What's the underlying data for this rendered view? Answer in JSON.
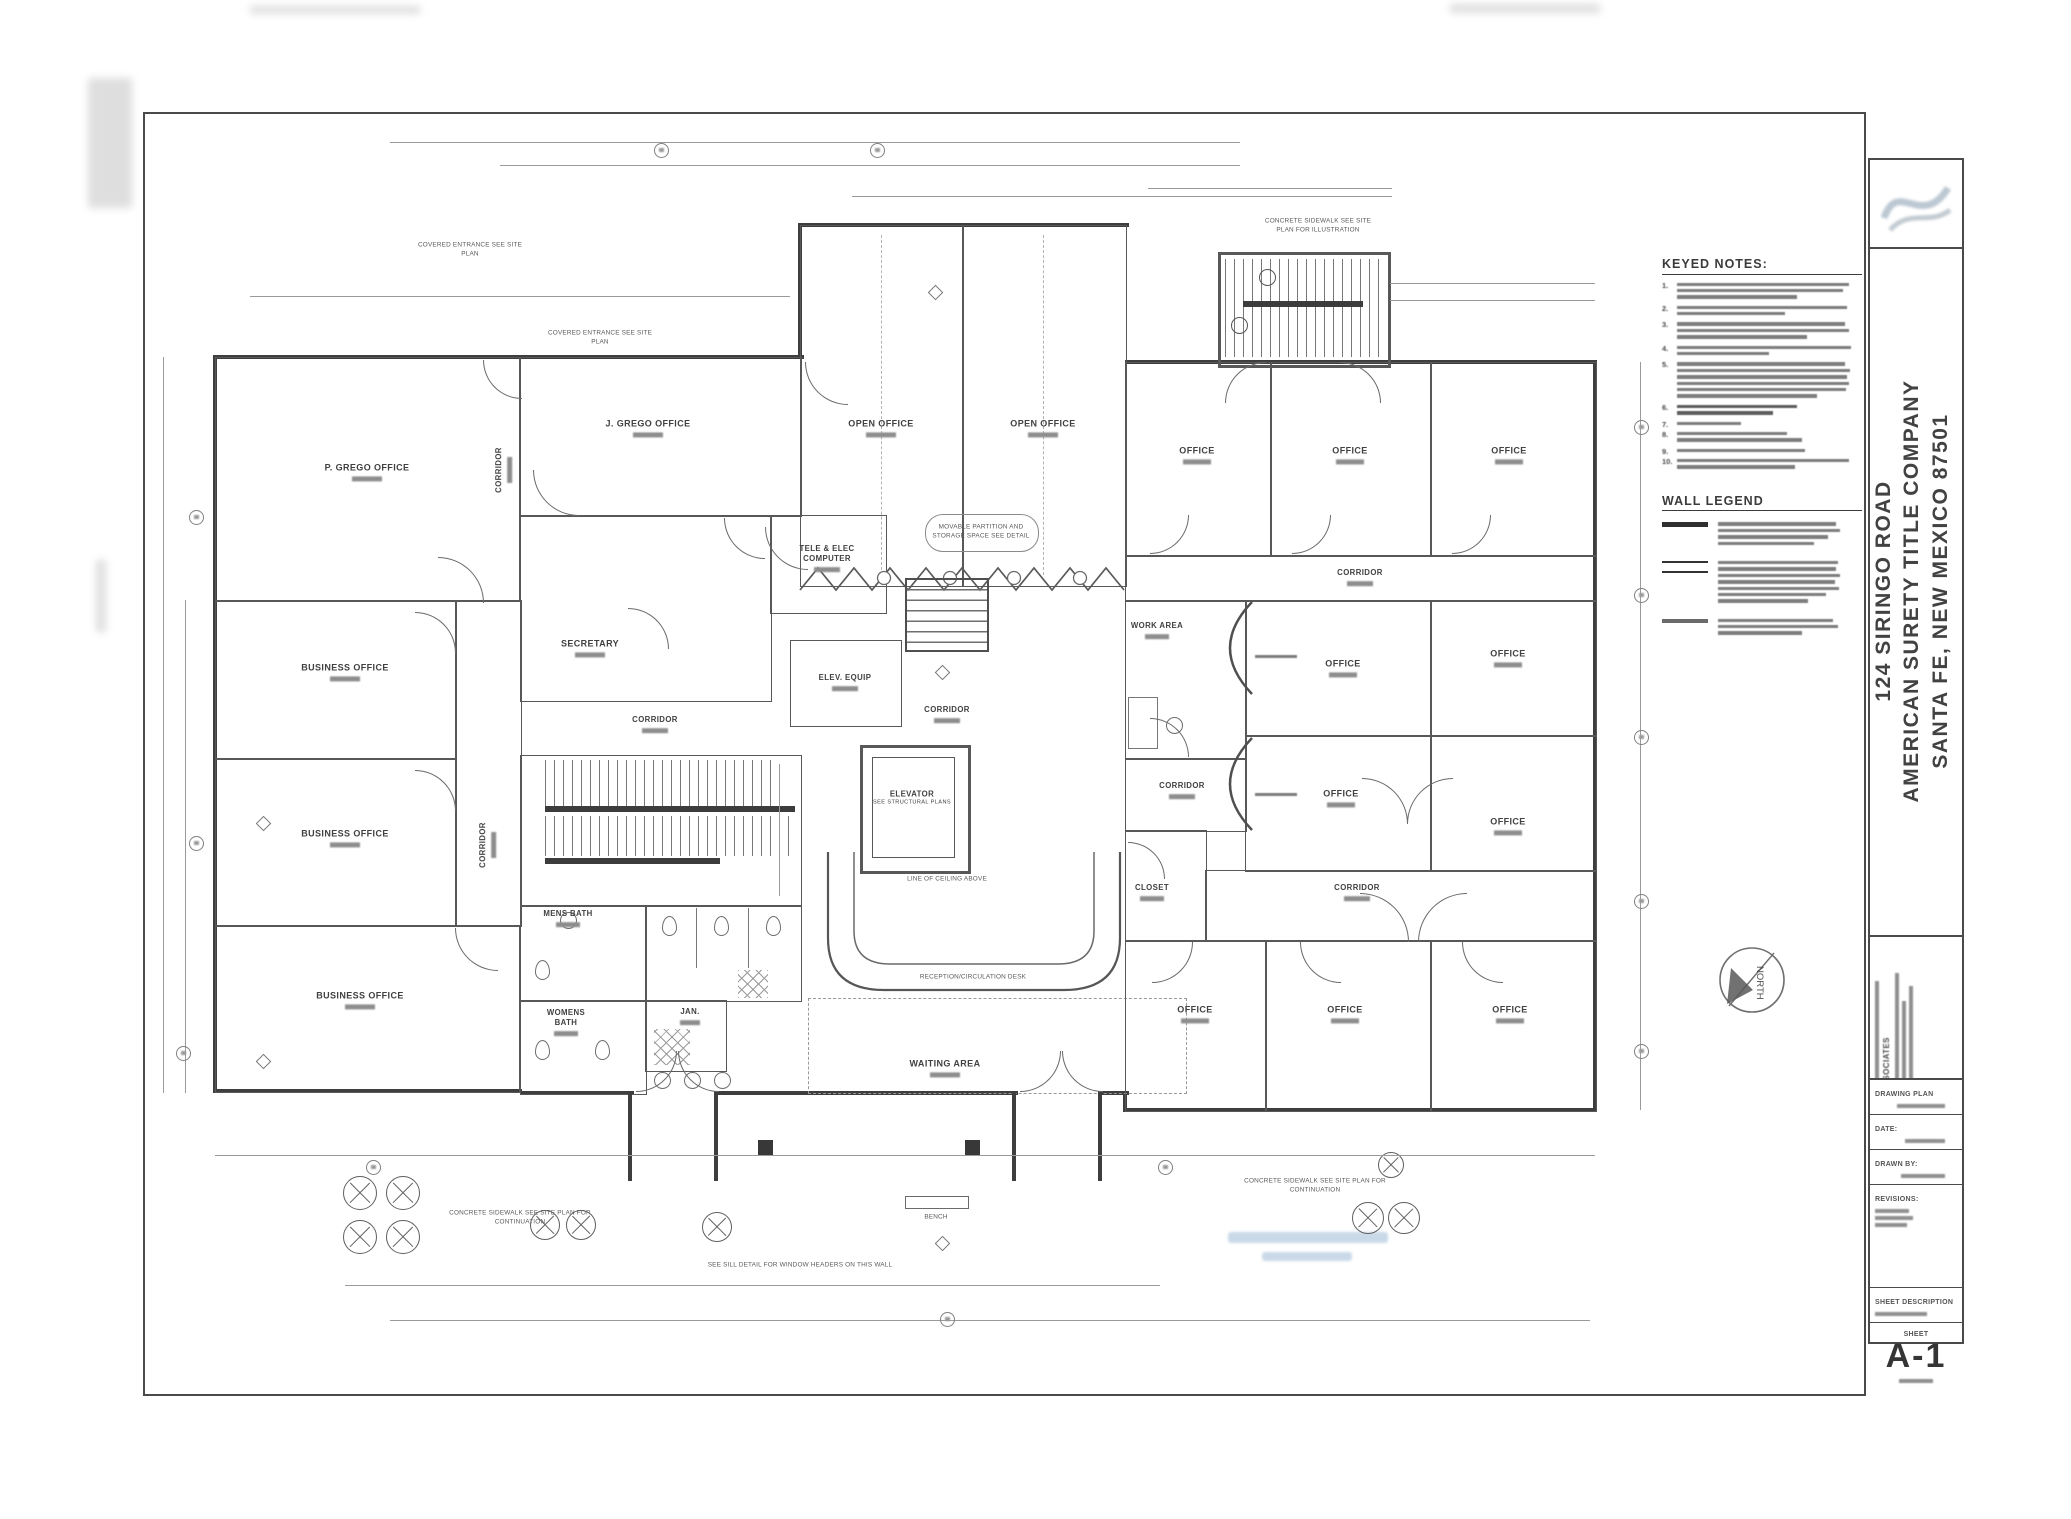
{
  "panel": {
    "keyed_notes_title": "KEYED NOTES:",
    "wall_legend_title": "WALL LEGEND",
    "note_numbers": [
      "1.",
      "2.",
      "3.",
      "4.",
      "5.",
      "6.",
      "7.",
      "8.",
      "9.",
      "10."
    ]
  },
  "title_block": {
    "address_line": "124 SIRINGO ROAD",
    "company_line": "AMERICAN SURETY TITLE COMPANY",
    "city_line": "SANTA FE, NEW MEXICO 87501",
    "firm_suffix": "& ASSOCIATES",
    "row_drawing_label": "DRAWING PLAN",
    "row_date_label": "DATE:",
    "row_drawn_label": "DRAWN BY:",
    "row_revisions_label": "REVISIONS:",
    "sheet_desc_label": "SHEET DESCRIPTION",
    "sheet_word": "SHEET",
    "sheet_number": "A-1",
    "north_label": "NORTH"
  },
  "rooms": {
    "p_grego": "P. GREGO OFFICE",
    "j_grego": "J. GREGO OFFICE",
    "business_office": "BUSINESS OFFICE",
    "secretary": "SECRETARY",
    "tele_elec_1": "TELE & ELEC",
    "tele_elec_2": "COMPUTER",
    "elev_equip": "ELEV. EQUIP",
    "corridor": "CORRIDOR",
    "open_office": "OPEN OFFICE",
    "office": "OFFICE",
    "elevator": "ELEVATOR",
    "elevator_sub": "SEE STRUCTURAL PLANS",
    "waiting_area": "WAITING AREA",
    "mens_bath": "MENS BATH",
    "womens_bath": "WOMENS BATH",
    "jan": "JAN.",
    "work_area": "WORK AREA",
    "closet": "CLOSET"
  },
  "site_notes": {
    "covered_entrance": "COVERED ENTRANCE SEE SITE PLAN",
    "sidewalk_illustration": "CONCRETE SIDEWALK SEE SITE PLAN FOR ILLUSTRATION",
    "sidewalk_continuation": "CONCRETE SIDEWALK SEE SITE PLAN FOR CONTINUATION",
    "movable_partition": "MOVABLE PARTITION AND STORAGE SPACE SEE DETAIL",
    "reception_desk": "RECEPTION/CIRCULATION DESK",
    "ceiling_line": "LINE OF CEILING ABOVE",
    "bench": "BENCH",
    "sill_note": "SEE SILL DETAIL FOR WINDOW HEADERS ON THIS WALL"
  }
}
